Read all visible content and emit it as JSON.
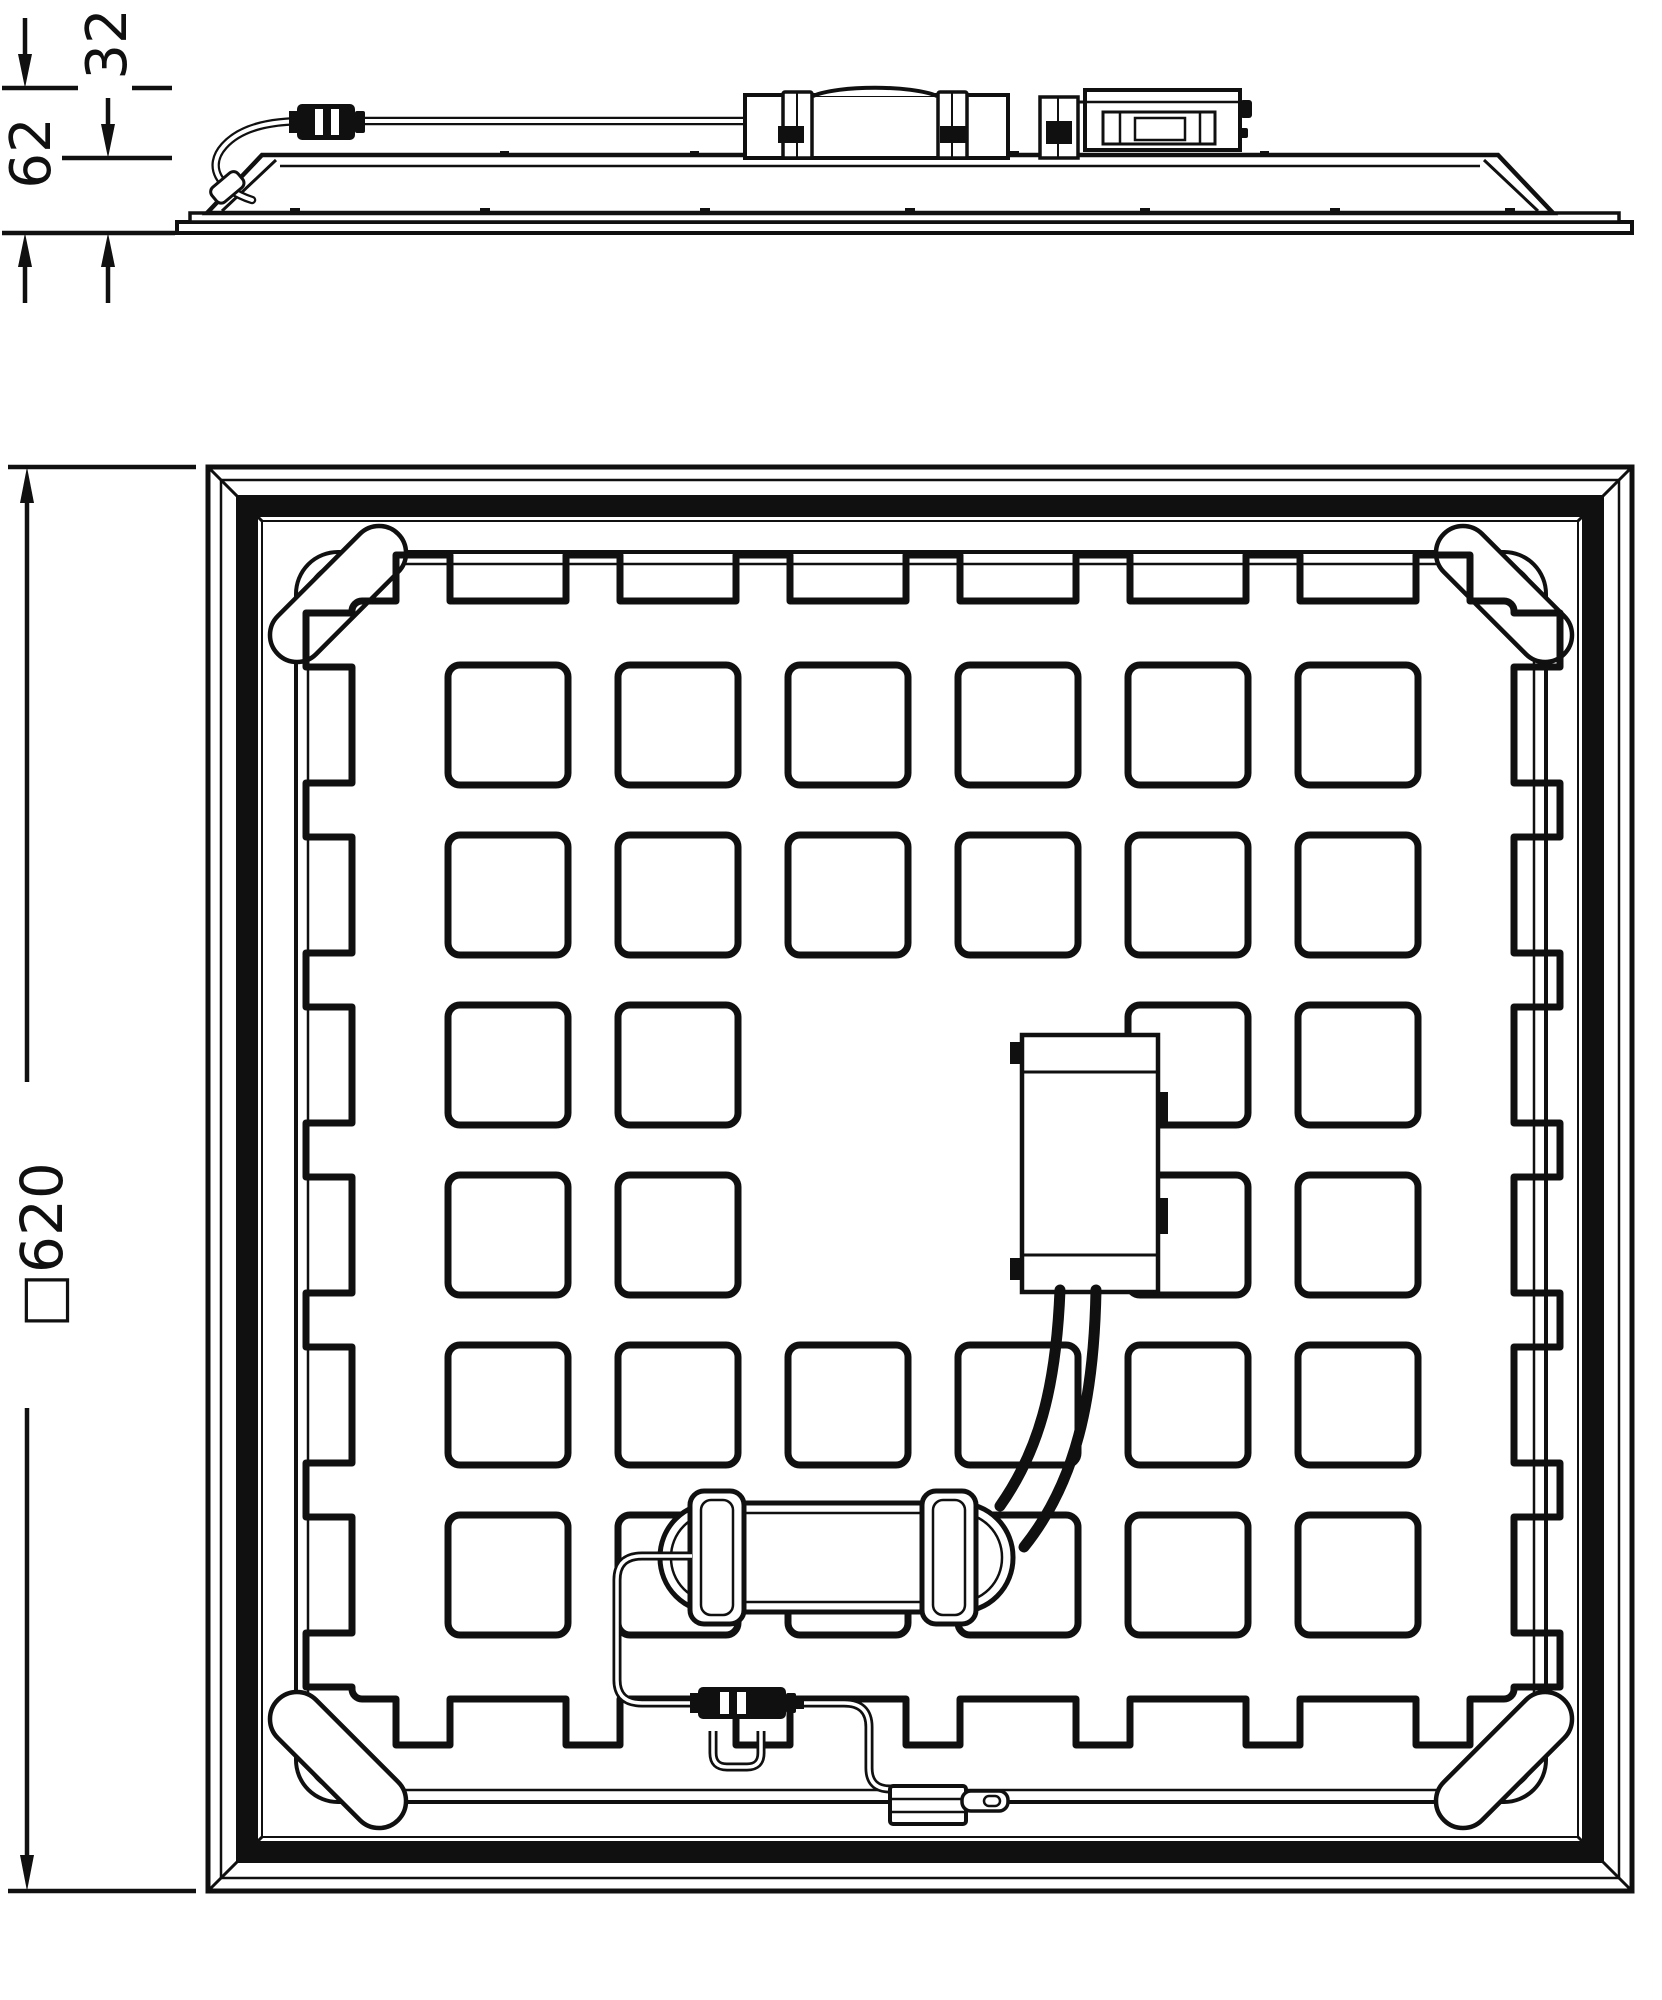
{
  "drawing": {
    "kind": "technical-dimension-drawing",
    "views": {
      "side_view": "panel profile with driver unit, inline connector and looping supply cable",
      "rear_view": "square panel back with waffle emboss pattern, driver box, driver capsule, connectors and cables"
    },
    "dimensions": {
      "side_total_height": "62",
      "side_panel_height": "32",
      "panel_square_size": "□620"
    },
    "colors": {
      "line": "#101010",
      "background": "#ffffff"
    }
  }
}
